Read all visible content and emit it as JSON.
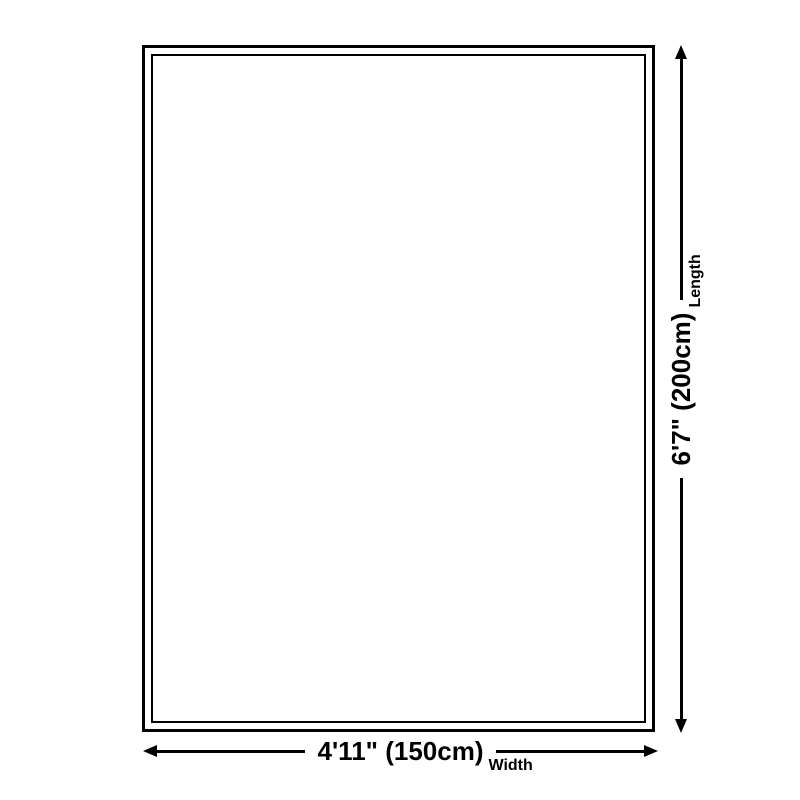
{
  "diagram": {
    "colors": {
      "line": "#000000",
      "background": "#ffffff"
    },
    "length_dimension": {
      "value": "6'7\" (200cm)",
      "axis_label": "Length"
    },
    "width_dimension": {
      "value": "4'11\" (150cm)",
      "axis_label": "Width"
    }
  }
}
